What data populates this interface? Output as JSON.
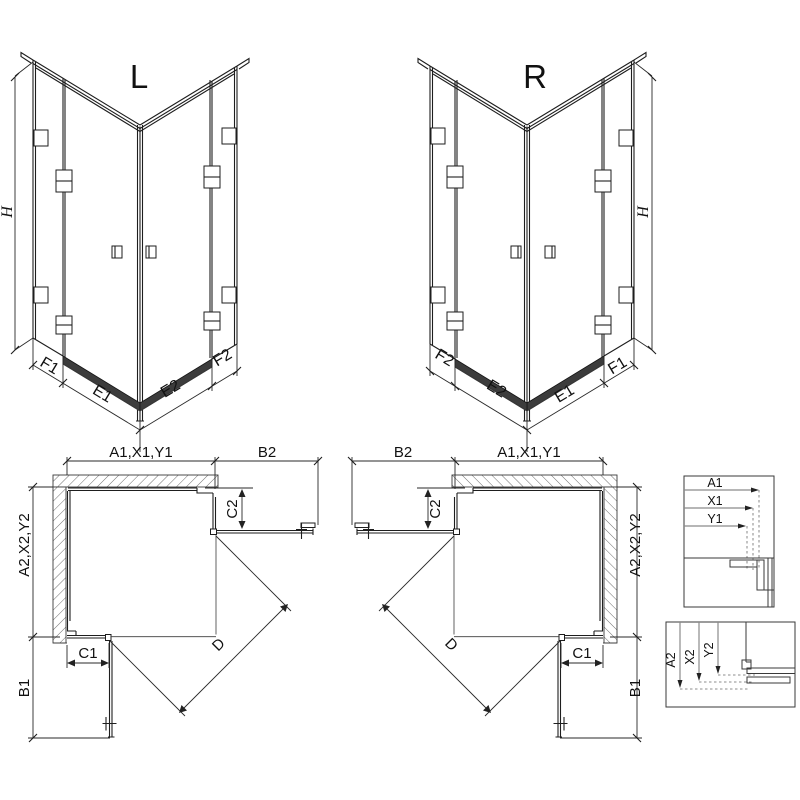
{
  "diagram": {
    "iso_left": {
      "title": "L",
      "height": "H",
      "segments": {
        "f1": "F1",
        "e1": "E1",
        "e2": "E2",
        "f2": "F2"
      }
    },
    "iso_right": {
      "title": "R",
      "height": "H",
      "segments": {
        "f1": "F1",
        "e1": "E1",
        "e2": "E2",
        "f2": "F2"
      }
    },
    "plan_left": {
      "top_width": "A1,X1,Y1",
      "top_door": "B2",
      "side_depth": "A2,X2,Y2",
      "side_door": "B1",
      "return_bottom": "C1",
      "return_side": "C2",
      "diagonal": "D"
    },
    "plan_right": {
      "top_width": "A1,X1,Y1",
      "top_door": "B2",
      "side_depth": "A2,X2,Y2",
      "side_door": "B1",
      "return_bottom": "C1",
      "return_side": "C2",
      "diagonal": "D"
    },
    "detail_horizontal": {
      "rows": [
        "A1",
        "X1",
        "Y1"
      ]
    },
    "detail_vertical": {
      "rows": [
        "A2",
        "X2",
        "Y2"
      ]
    },
    "colors": {
      "line": "#1e1e1e",
      "hatch": "#6e6e6e",
      "profile_fill": "#3c3c3c"
    }
  }
}
